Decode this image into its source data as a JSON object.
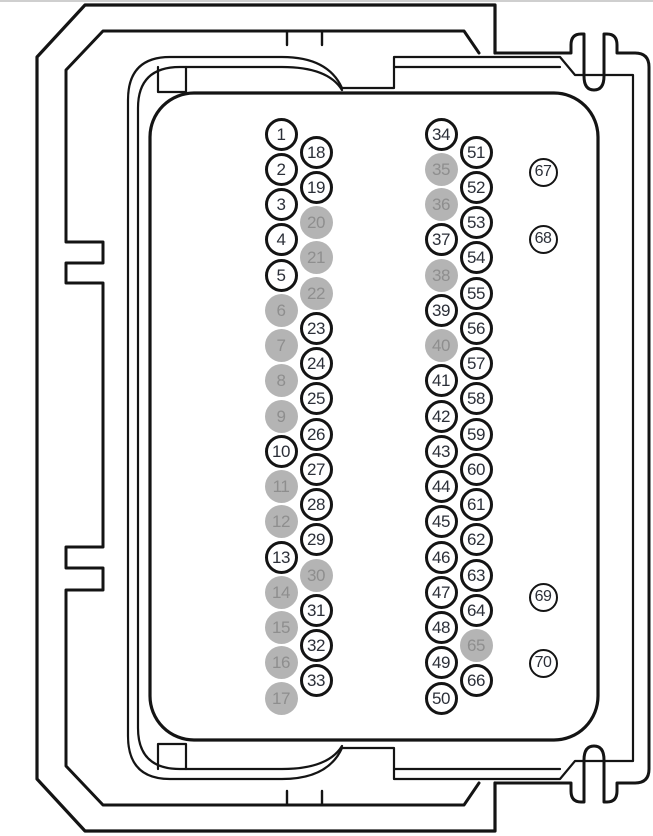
{
  "diagram": {
    "name": "70-pin ECU connector pinout",
    "total_pins": 70
  },
  "colors": {
    "outline": "#141414",
    "background": "#ffffff",
    "pin_text": "#2b2f38",
    "pin_shaded_fill": "#b4b4b4",
    "pin_shaded_text": "#8e8e8e",
    "top_hairline": "#cfcfcf"
  },
  "connector": {
    "shaded_pins": [
      6,
      7,
      8,
      9,
      11,
      12,
      14,
      15,
      16,
      17,
      20,
      21,
      22,
      30,
      35,
      36,
      38,
      40,
      65
    ],
    "columns": [
      {
        "name": "left-outer",
        "pins": [
          1,
          2,
          3,
          4,
          5,
          6,
          7,
          8,
          9,
          10,
          11,
          12,
          13,
          14,
          15,
          16,
          17
        ]
      },
      {
        "name": "left-inner",
        "pins": [
          18,
          19,
          20,
          21,
          22,
          23,
          24,
          25,
          26,
          27,
          28,
          29,
          30,
          31,
          32,
          33
        ]
      },
      {
        "name": "right-outer",
        "pins": [
          34,
          35,
          36,
          37,
          38,
          39,
          40,
          41,
          42,
          43,
          44,
          45,
          46,
          47,
          48,
          49,
          50
        ]
      },
      {
        "name": "right-inner",
        "pins": [
          51,
          52,
          53,
          54,
          55,
          56,
          57,
          58,
          59,
          60,
          61,
          62,
          63,
          64,
          65,
          66
        ]
      },
      {
        "name": "side-right",
        "pins": [
          67,
          68,
          69,
          70
        ]
      }
    ]
  }
}
